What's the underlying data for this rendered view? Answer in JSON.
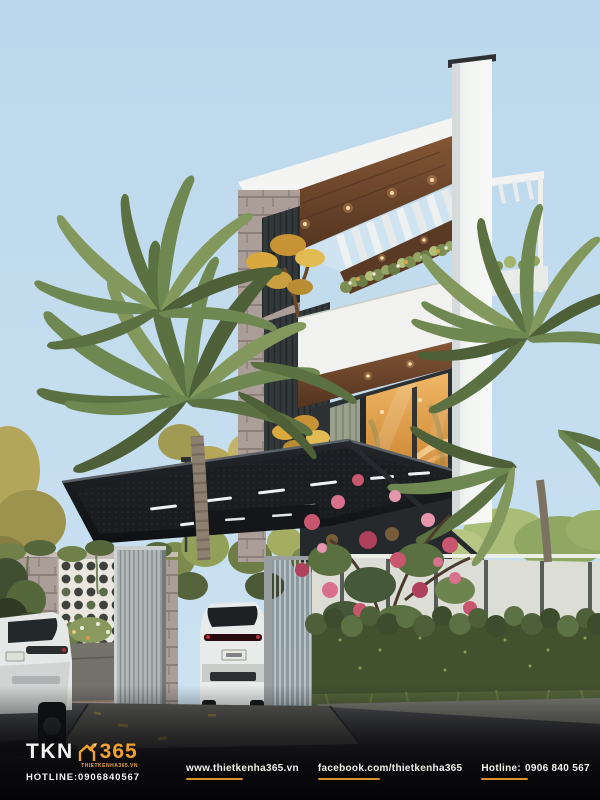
{
  "branding": {
    "logo_text_1": "TKN",
    "logo_text_2": "365",
    "logo_site": "THIETKENHA365.VN",
    "logo_hotline": "HOTLINE:0906840567",
    "accent_color": "#f0a233"
  },
  "footer": {
    "website": "www.thietkenha365.vn",
    "facebook": "facebook.com/thietkenha365",
    "hotline_label": "Hotline:",
    "hotline_number": "0906 840 567"
  },
  "scene": {
    "type": "architectural-exterior-render",
    "subject": "modern-3-storey-townhouse",
    "colors": {
      "sky": "#bdd9ec",
      "house_white": "#f4f5f3",
      "wood_soffit": "#6e4a2f",
      "carport_canopy": "#1b1e21",
      "window_warm_light": "#d98f3f",
      "palm_green": "#718a52",
      "hedge_green": "#47573a",
      "bougainvillea_pink": "#c8566f",
      "stone_wall": "#b1a29c",
      "street": "#3a3b3d"
    }
  }
}
